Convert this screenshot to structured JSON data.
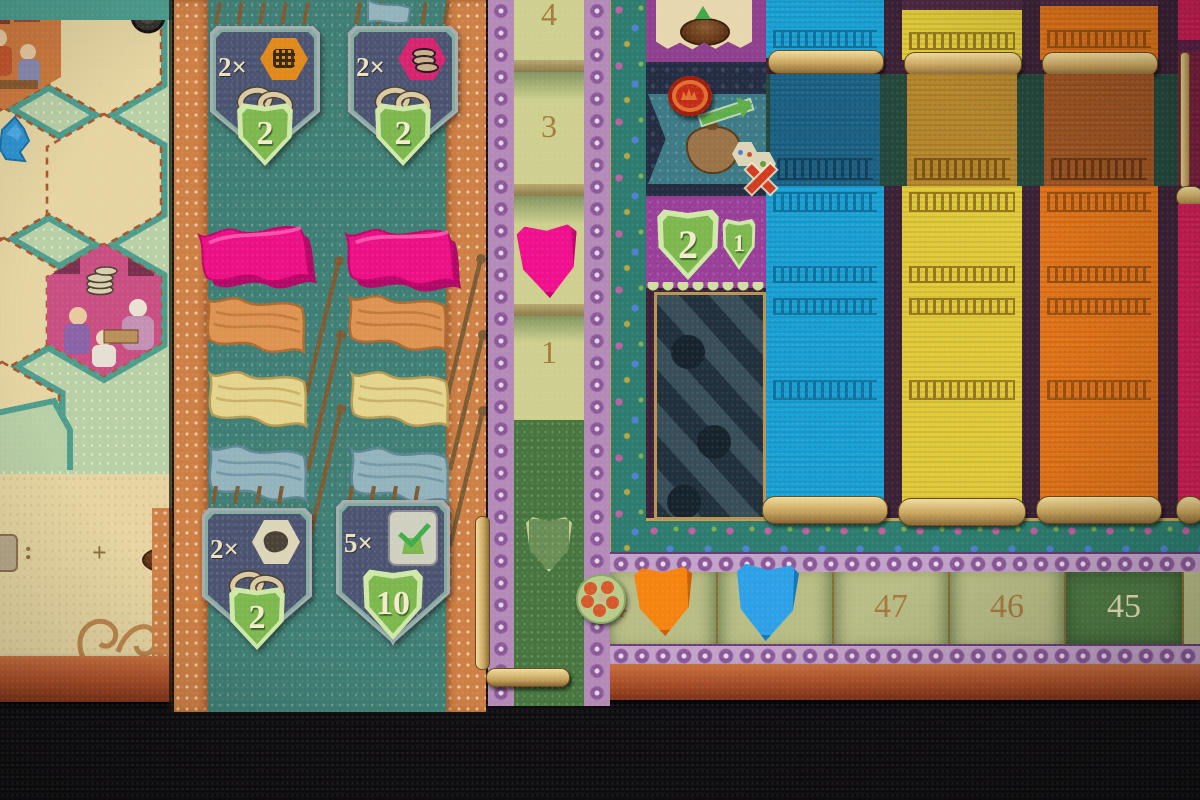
{
  "photo": {
    "subject": "tabletop board game close-up: hex map board, flag supply panel, rank track and cloth-scroll market board with score track"
  },
  "palette": {
    "board_beige": "#e6d5a2",
    "panel_teal": "#3f7e74",
    "mint_green": "#b9cfa6",
    "accent_orange": "#cd7f45",
    "track_purple": "#b48ab8",
    "market_blue": "#1aa2d6",
    "market_yellow": "#e2cb3a",
    "market_orange": "#e27419",
    "market_pink": "#d01e56",
    "piece_pink": "#ec1087",
    "piece_orange": "#f5830f",
    "piece_blue": "#2da1e8"
  },
  "left_board": {
    "illustrated_hexes": [
      {
        "name": "market-scene"
      },
      {
        "name": "traders-with-coins"
      }
    ],
    "formula": {
      "colon": ":",
      "plus": "+",
      "close": ")"
    }
  },
  "flag_panel": {
    "top_tiles": [
      {
        "multiplier": "2×",
        "icon": "orange-hex-weave",
        "reward": "2"
      },
      {
        "multiplier": "2×",
        "icon": "magenta-hex-coins",
        "reward": "2"
      }
    ],
    "bottom_tiles": [
      {
        "multiplier": "2×",
        "icon": "white-hex-glove",
        "reward": "2"
      },
      {
        "multiplier": "5×",
        "icon": "green-checkmark",
        "reward": "10"
      }
    ],
    "printed_flag_colors": [
      "orange",
      "yellow",
      "blue"
    ],
    "pieces": [
      {
        "type": "flag",
        "color": "pink"
      },
      {
        "type": "flag",
        "color": "pink"
      }
    ]
  },
  "rank_track": {
    "spaces": [
      {
        "label": "4"
      },
      {
        "label": "3"
      },
      {
        "label": "",
        "piece": "pink-shield-token"
      },
      {
        "label": "1"
      }
    ]
  },
  "action_column": {
    "top_space_icon": "disc-with-up-arrow",
    "middle_banner_icons": [
      "red-disc-token",
      "goods-sack",
      "green-upgrade-arrow",
      "dice-with-red-x"
    ],
    "reward_banner": {
      "shield_large": "2",
      "shield_small": "1"
    }
  },
  "cloth_market": {
    "columns": [
      {
        "color": "blue"
      },
      {
        "color": "yellow"
      },
      {
        "color": "orange"
      },
      {
        "color": "pink"
      }
    ]
  },
  "score_track": {
    "cells": [
      {
        "label": "4",
        "piece": "orange-shield-token"
      },
      {
        "label": "",
        "piece": "blue-shield-token"
      },
      {
        "label": "47"
      },
      {
        "label": "46"
      },
      {
        "label": "45",
        "dark": true
      },
      {
        "label": ""
      }
    ]
  }
}
